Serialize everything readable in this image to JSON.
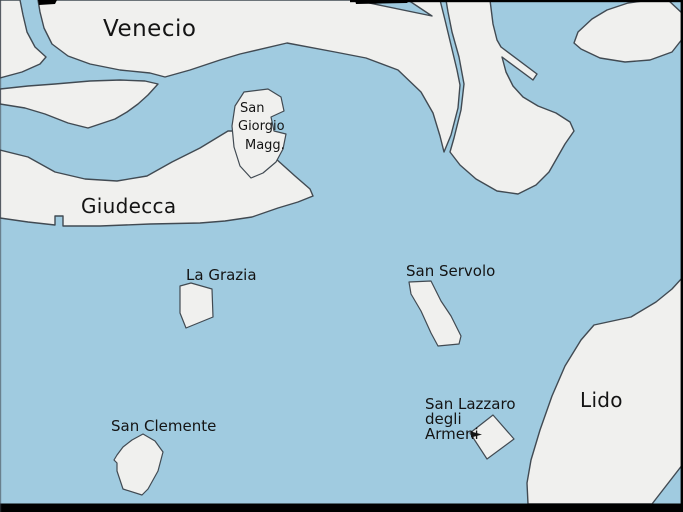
{
  "map": {
    "colors": {
      "water": "#a0cbe0",
      "land": "#f0f0ee",
      "outline": "#414a52",
      "frame": "#000000",
      "label": "#141414"
    },
    "labels": {
      "venecio": "Venecio",
      "san_giorgio_line1": "San",
      "san_giorgio_line2": "Giorgio",
      "san_giorgio_line3": "Magg.",
      "giudecca": "Giudecca",
      "la_grazia": "La Grazia",
      "san_servolo": "San Servolo",
      "san_clemente": "San Clemente",
      "san_lazzaro_line1": "San Lazzaro",
      "san_lazzaro_line2": "degli",
      "san_lazzaro_line3": "Armeni",
      "lido": "Lido"
    },
    "regions": [
      "Venecio",
      "Giudecca",
      "San Giorgio Magg.",
      "La Grazia",
      "San Servolo",
      "San Clemente",
      "San Lazzaro degli Armeni",
      "Lido"
    ]
  }
}
